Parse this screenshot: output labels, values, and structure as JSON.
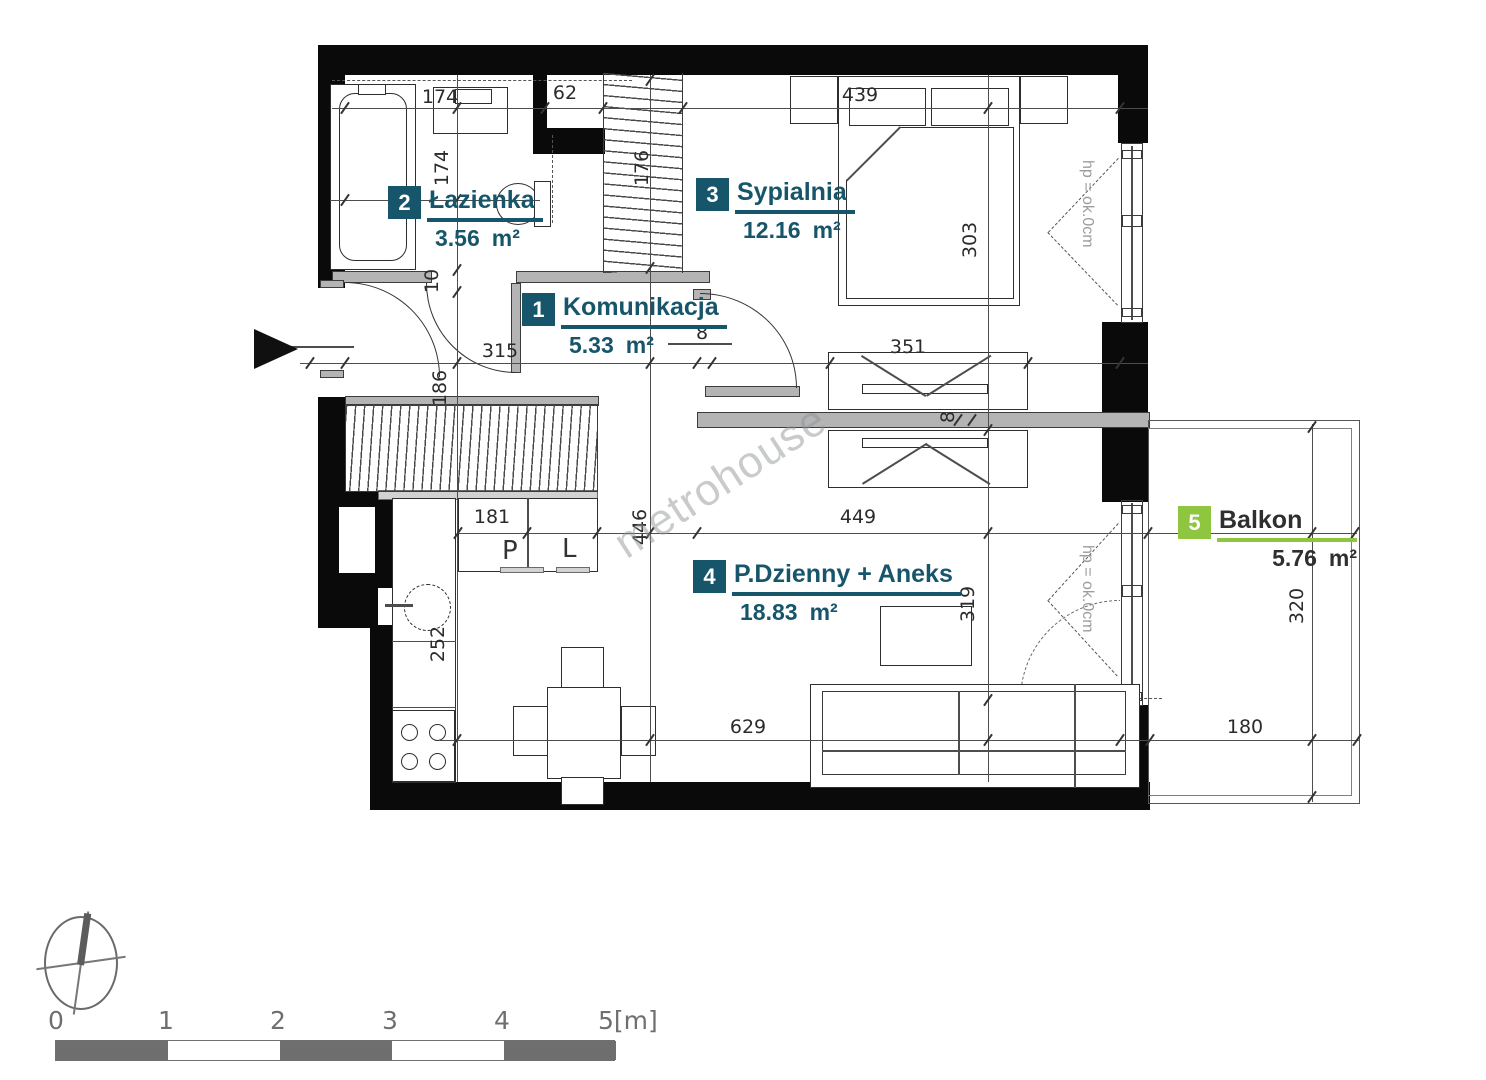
{
  "plan": {
    "watermark": "metrohouse",
    "rooms": [
      {
        "num": "1",
        "name": "Komunikacja",
        "area": "5.33",
        "unit": "m²"
      },
      {
        "num": "2",
        "name": "Łazienka",
        "area": "3.56",
        "unit": "m²"
      },
      {
        "num": "3",
        "name": "Sypialnia",
        "area": "12.16",
        "unit": "m²"
      },
      {
        "num": "4",
        "name": "P.Dzienny + Aneks",
        "area": "18.83",
        "unit": "m²"
      },
      {
        "num": "5",
        "name": "Balkon",
        "area": "5.76",
        "unit": "m²"
      }
    ],
    "dims": {
      "bath_w": "174",
      "niche": "62",
      "bed_w": "439",
      "bath_h": "174",
      "closet_h": "176",
      "bed_d": "303",
      "wall10": "10",
      "hall_w": "315",
      "gap8_top": "8",
      "wardrobe_w": "351",
      "entry_h": "186",
      "gap8_mid": "8",
      "kitchen_w": "181",
      "mid_h": "446",
      "living_w": "449",
      "kitchen_h": "252",
      "living_d": "319",
      "bottom_w": "629",
      "balcony_h": "320",
      "balcony_w": "180"
    },
    "labels": {
      "cab_p": "P",
      "cab_l": "L",
      "hp_bed": "hp = ok.0cm",
      "hp_living": "hp = ok.0cm"
    },
    "scalebar": {
      "l0": "0",
      "l1": "1",
      "l2": "2",
      "l3": "3",
      "l4": "4",
      "l5": "5[m]"
    },
    "colors": {
      "room_label": "#17566a",
      "balcony_label": "#8fc640"
    }
  }
}
